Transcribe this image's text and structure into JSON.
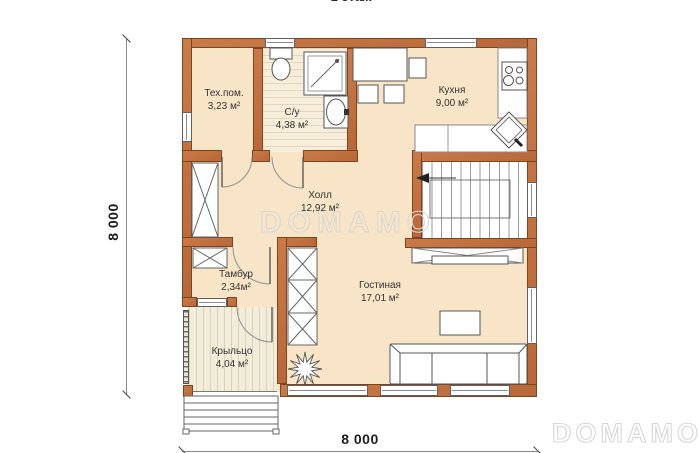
{
  "floor_label": "1 этаж",
  "dimensions": {
    "left": "8 000",
    "bottom": "8 000"
  },
  "watermarks": {
    "center": "DOMAMO",
    "corner": "DOMAMO"
  },
  "rooms": {
    "tech": {
      "name": "Тех.пом.",
      "area": "3,23 м²"
    },
    "bath": {
      "name": "С/у",
      "area": "4,38 м²"
    },
    "kitchen": {
      "name": "Кухня",
      "area": "9,00 м²"
    },
    "hall": {
      "name": "Холл",
      "area": "12,92 м²"
    },
    "tambour": {
      "name": "Тамбур",
      "area": "2,34м²"
    },
    "living": {
      "name": "Гостиная",
      "area": "17,01 м²"
    },
    "porch": {
      "name": "Крыльцо",
      "area": "4,04 м²"
    }
  },
  "colors": {
    "wall": "#c2713f",
    "wall_outline": "#7d4420",
    "floor": "#f8e5c8",
    "bath_floor": "#f7eddb",
    "porch_floor": "#f2ecdb",
    "drawing_line": "#555555",
    "watermark": "#d7d7d7"
  }
}
